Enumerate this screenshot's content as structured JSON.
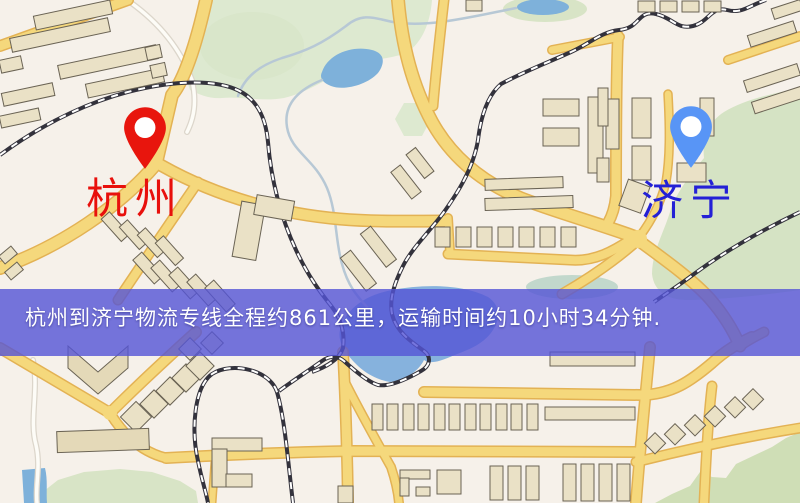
{
  "map": {
    "type": "road-map",
    "banner": {
      "text": "杭州到济宁物流专线全程约861公里，运输时间约10小时34分钟."
    },
    "route": {
      "origin": "杭州",
      "destination": "济宁",
      "distance_text": "约861公里",
      "duration_text": "约10小时34分钟"
    },
    "markers": [
      {
        "id": "hangzhou",
        "label": "杭州",
        "pin_color": "#e8150d",
        "position": {
          "x": 145,
          "y": 169
        }
      },
      {
        "id": "jining",
        "label": "济宁",
        "pin_color": "#5895f6",
        "position": {
          "x": 691,
          "y": 168
        }
      }
    ],
    "colors": {
      "map_base": "#f6f1ea",
      "road_fill": "#f5d87c",
      "road_edge": "#e3b254",
      "bldg": "#eae1c6",
      "bldg_dark": "#e4d9b8",
      "bldg_edge": "#6a6354",
      "green": "#dde9d0",
      "green_mid": "#d5e3c4",
      "green_low": "#d8e4c6",
      "green_hill": "#cfdeb6",
      "water": "#7eb1da",
      "water2": "#86b2dd",
      "stream": "#b7c8d5",
      "rail_dark": "#33323c",
      "banner_bg": "rgba(84,84,214,0.8)",
      "banner_text": "#ffffff",
      "label_hangzhou": "#e8100c",
      "label_jining": "#2420d6"
    }
  }
}
